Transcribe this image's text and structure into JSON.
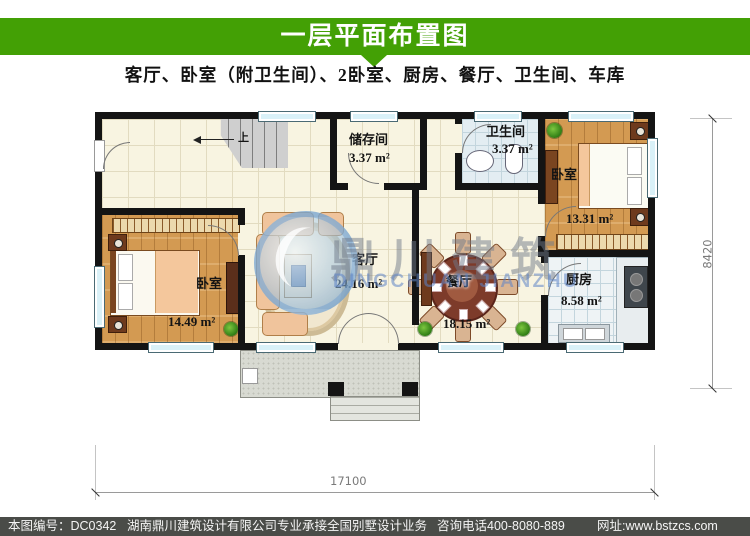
{
  "header": {
    "title": "一层平面布置图",
    "subtitle": "客厅、卧室（附卫生间）、2卧室、厨房、餐厅、卫生间、车库",
    "accent_green": "#43a005"
  },
  "plan": {
    "rooms": {
      "storage": {
        "name": "储存间",
        "area": "3.37 m²"
      },
      "bathroom": {
        "name": "卫生间",
        "area": "3.37 m²"
      },
      "bedroom_right": {
        "name": "卧室",
        "area": "13.31 m²"
      },
      "living": {
        "name": "客厅",
        "area": "24.16 m²"
      },
      "dining": {
        "name": "餐厅",
        "area": "18.15 m²"
      },
      "kitchen": {
        "name": "厨房",
        "area": "8.58 m²"
      },
      "bedroom_left": {
        "name": "卧室",
        "area": "14.49 m²"
      }
    },
    "stairs_up_label": "上",
    "dimensions": {
      "total_width": "17100",
      "total_depth": "8420"
    }
  },
  "watermark": {
    "cn": "鼎川建筑",
    "en": "DINGCHUAN JIANZHU"
  },
  "footer": {
    "number": "本图编号：DC0342",
    "company": "湖南鼎川建筑设计有限公司专业承接全国别墅设计业务",
    "phone": "咨询电话400-8080-889",
    "website": "网址:www.bstzcs.com",
    "bg_color": "#4a4c48"
  }
}
